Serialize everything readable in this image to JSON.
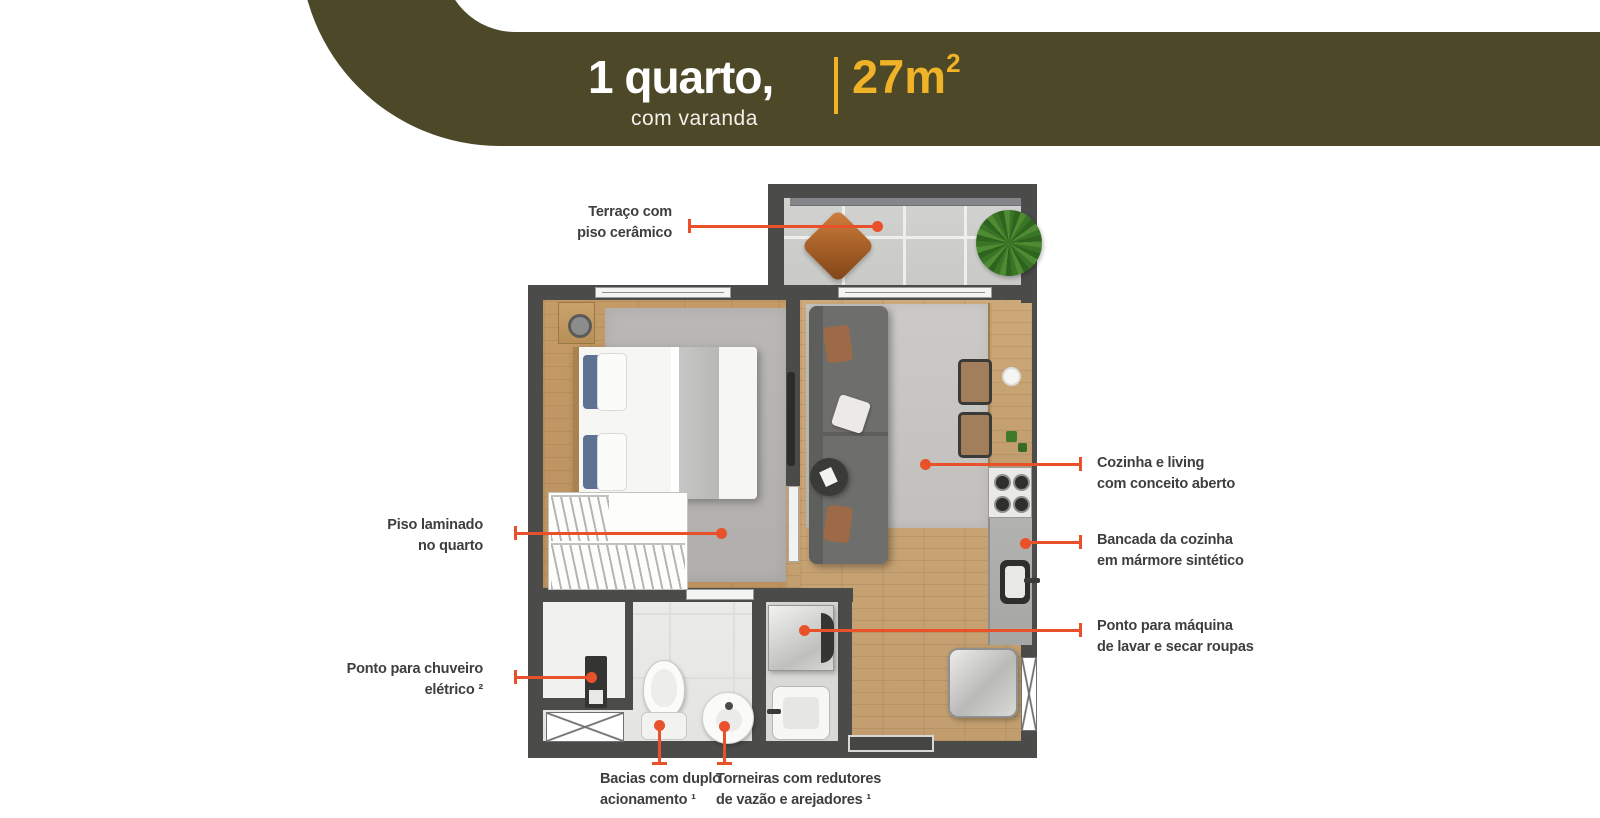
{
  "banner": {
    "title": "1 quarto,",
    "subtitle": "com varanda",
    "area_value": "27m",
    "area_sup": "2",
    "bg_color": "#4d4827",
    "accent_color": "#f0b226"
  },
  "annotations": [
    {
      "id": "terraco",
      "lines": [
        "Terraço com",
        "piso cerâmico"
      ]
    },
    {
      "id": "piso-laminado",
      "lines": [
        "Piso laminado",
        "no quarto"
      ]
    },
    {
      "id": "chuveiro",
      "lines": [
        "Ponto para chuveiro",
        "elétrico ²"
      ]
    },
    {
      "id": "cozinha-living",
      "lines": [
        "Cozinha e living",
        "com conceito aberto"
      ]
    },
    {
      "id": "bancada",
      "lines": [
        "Bancada da cozinha",
        "em mármore sintético"
      ]
    },
    {
      "id": "maquina",
      "lines": [
        "Ponto para máquina",
        "de lavar e secar roupas"
      ]
    },
    {
      "id": "bacias",
      "lines": [
        "Bacias com duplo",
        "acionamento ¹"
      ]
    },
    {
      "id": "torneiras",
      "lines": [
        "Torneiras com redutores",
        "de vazão e arejadores ¹"
      ]
    }
  ],
  "colors": {
    "banner_olive": "#4d4827",
    "accent_yellow": "#f0b226",
    "leader_orange": "#e8512a",
    "wall_gray": "#4b4b49",
    "label_text": "#3e3e3e"
  }
}
